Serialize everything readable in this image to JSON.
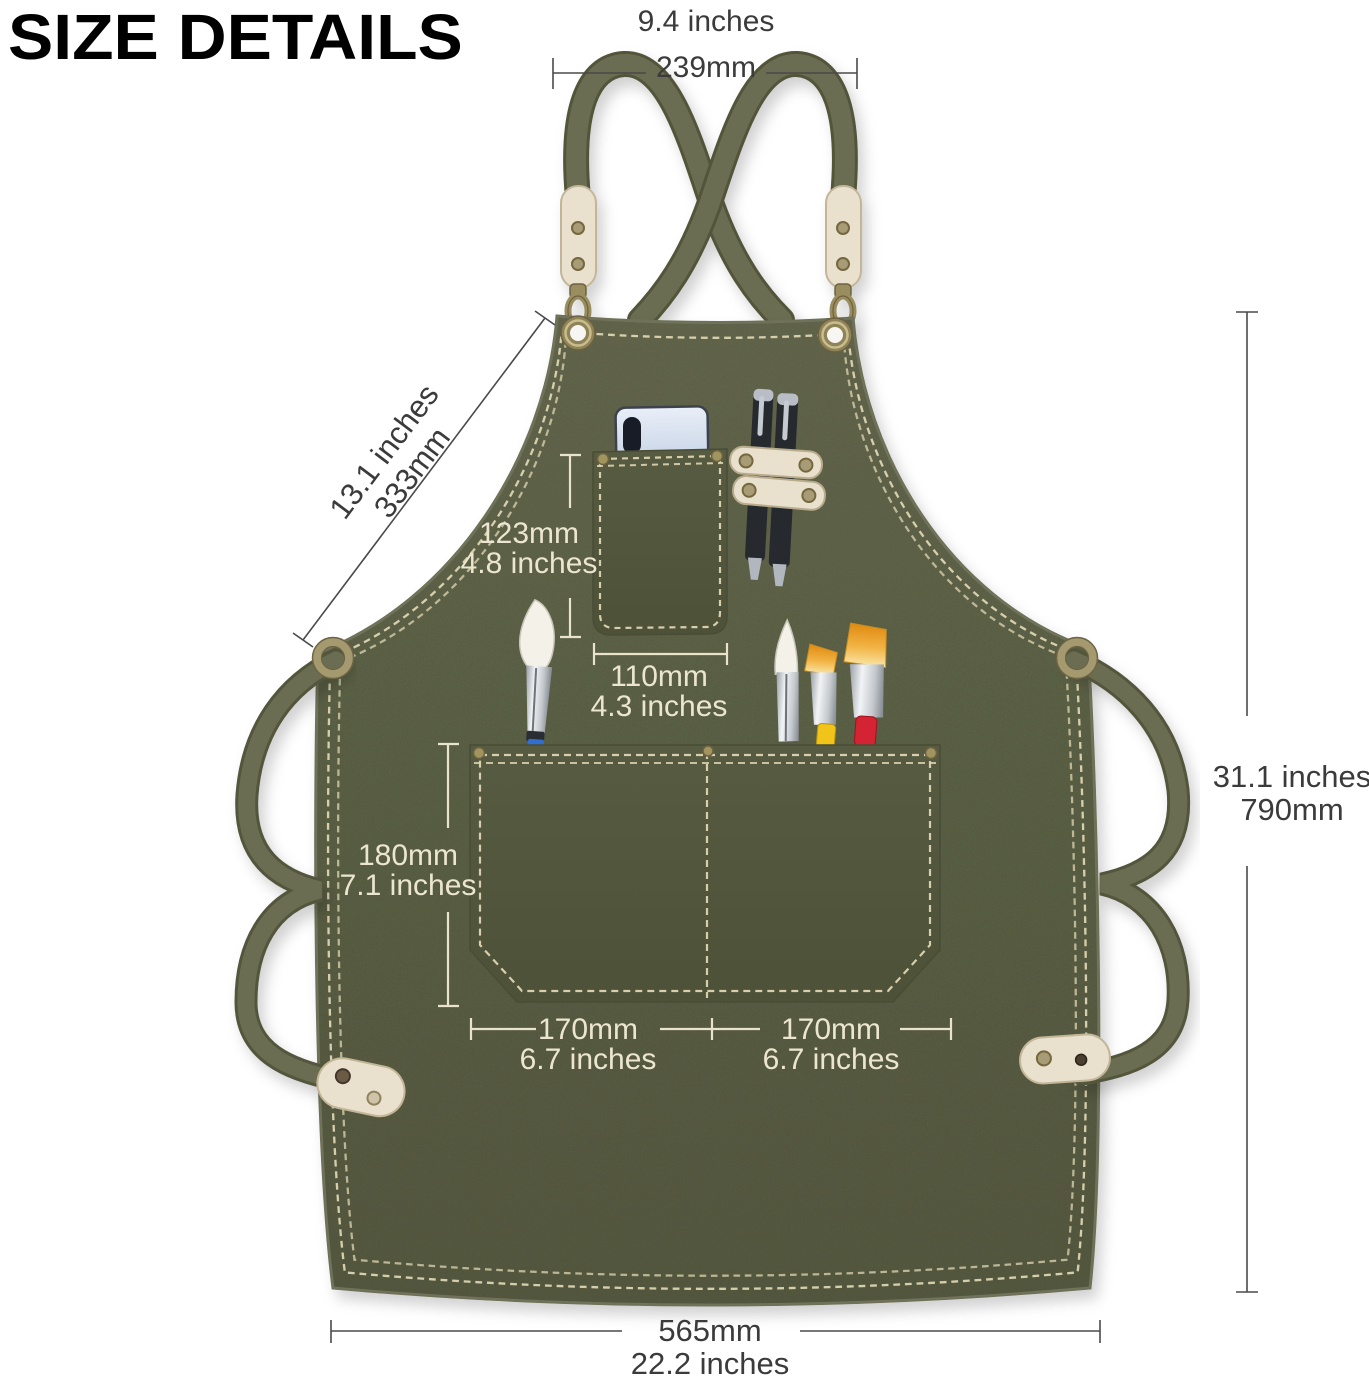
{
  "title": "SIZE DETAILS",
  "measurements": {
    "neck_width": {
      "line1": "9.4 inches",
      "line2": "239mm"
    },
    "bib_side": {
      "line1": "13.1 inches",
      "line2": "333mm"
    },
    "chest_pocket_height": {
      "line1": "123mm",
      "line2": "4.8 inches"
    },
    "chest_pocket_width": {
      "line1": "110mm",
      "line2": "4.3 inches"
    },
    "main_pocket_height": {
      "line1": "180mm",
      "line2": "7.1 inches"
    },
    "main_pocket_left": {
      "line1": "170mm",
      "line2": "6.7 inches"
    },
    "main_pocket_right": {
      "line1": "170mm",
      "line2": "6.7 inches"
    },
    "total_height": {
      "line1": "31.1 inches",
      "line2": "790mm"
    },
    "bottom_width": {
      "line1": "565mm",
      "line2": "22.2 inches"
    }
  },
  "colors": {
    "apron_green": "#565a40",
    "strap_olive": "#696c50",
    "stitch_cream": "#ddd5b2",
    "leather_cream": "#e9e1ce",
    "brass": "#9c8f63",
    "label_dark": "#3b3b3b",
    "label_light": "#ece6d0",
    "phone_blue": "#d6dfee",
    "pen_black": "#27292e",
    "bristle_gold": "#eb9b1e",
    "band_yellow": "#f0c419",
    "band_red": "#d42332",
    "band_blue": "#2f6fd0"
  },
  "objects": [
    "apron",
    "cross-back-shoulder-strap",
    "waist-strap",
    "grommet",
    "o-ring",
    "leather-tab",
    "swivel-hook",
    "leather-patch",
    "chest-pocket",
    "main-pocket",
    "smartphone",
    "pen",
    "pen-holder-strap",
    "paint-brush"
  ]
}
